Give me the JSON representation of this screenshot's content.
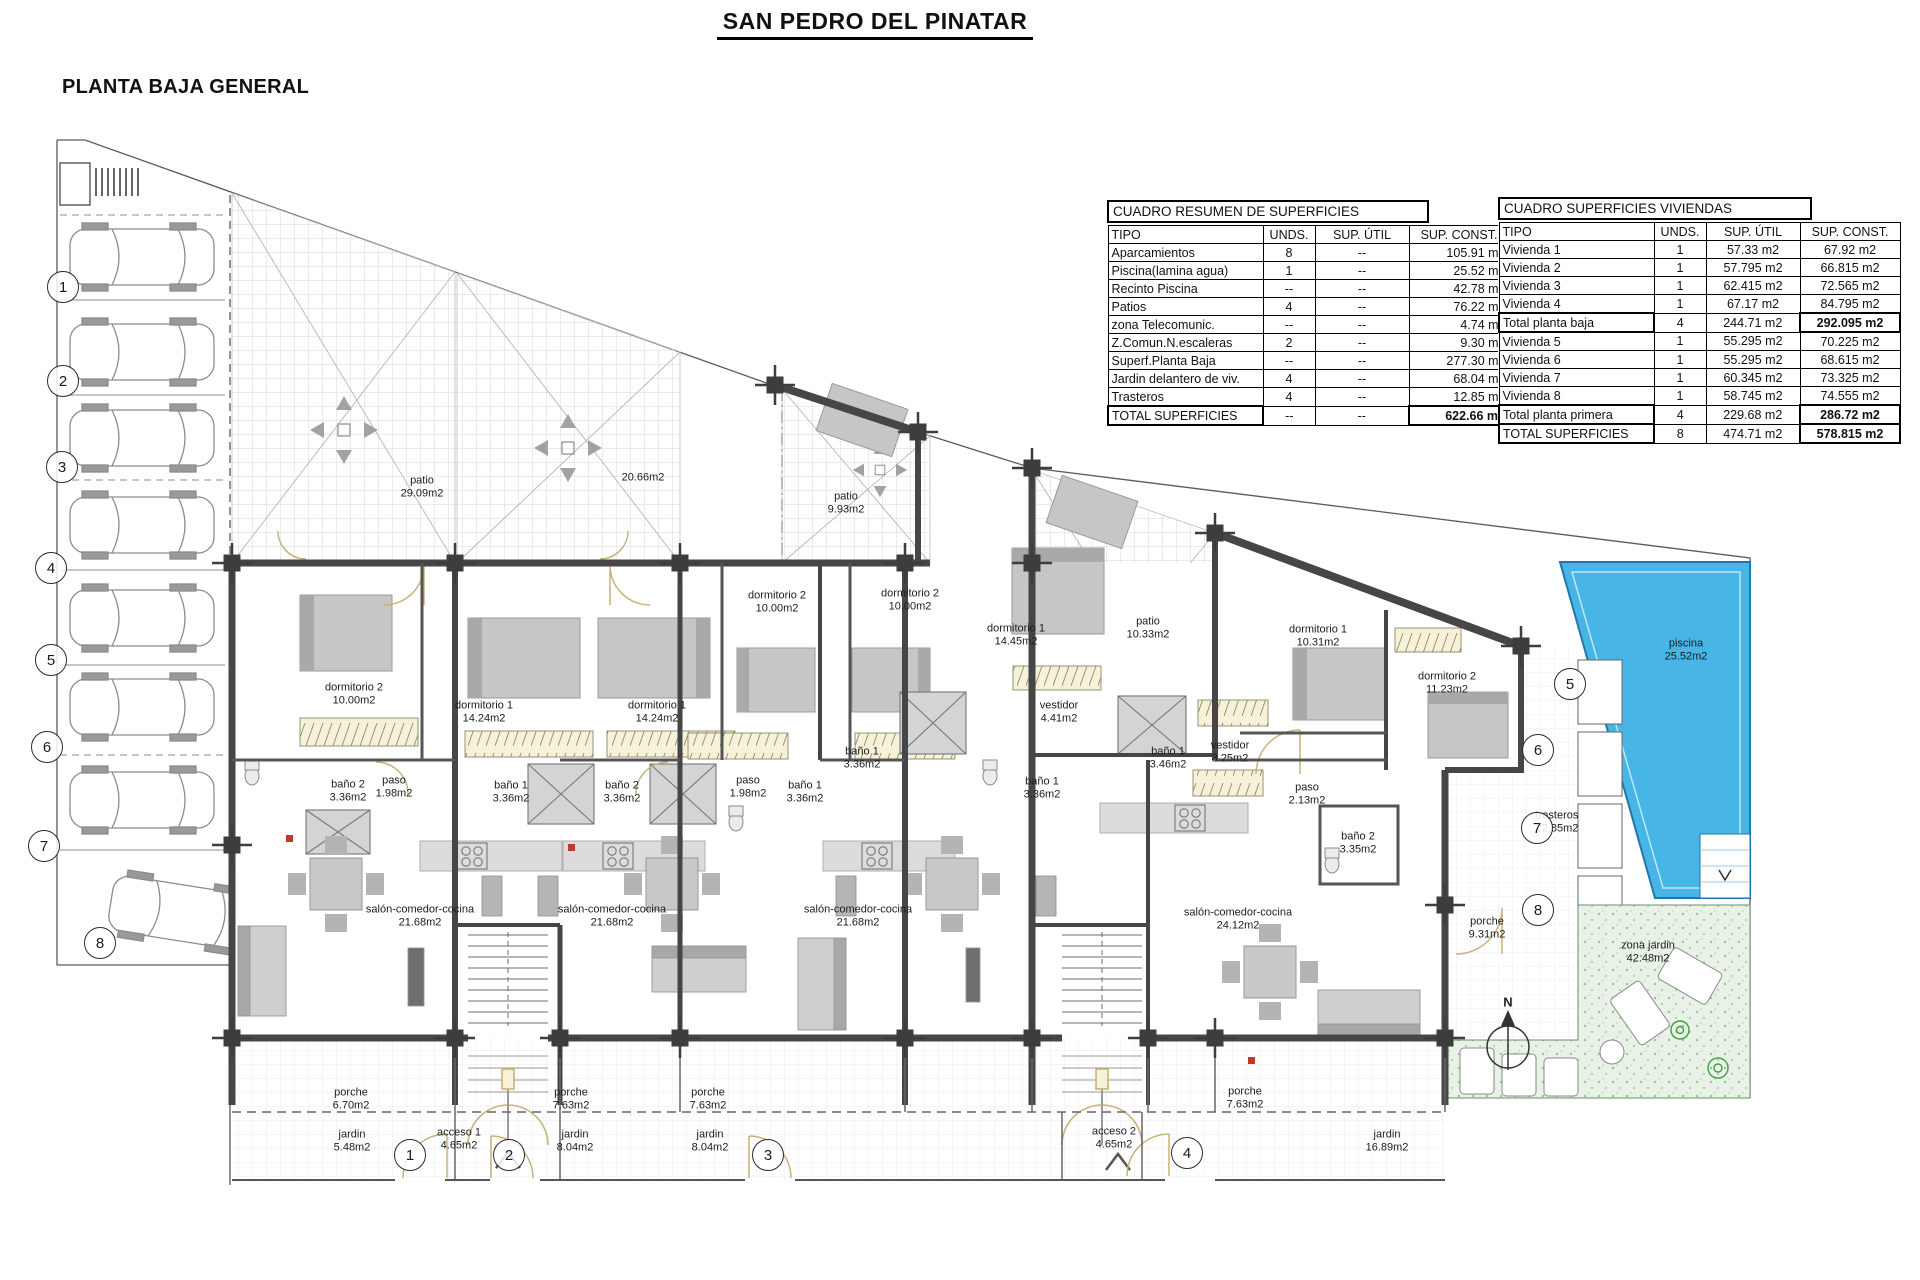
{
  "page": {
    "title": "SAN PEDRO DEL PINATAR",
    "subtitle": "PLANTA BAJA GENERAL"
  },
  "summary_table": {
    "title": "CUADRO RESUMEN DE SUPERFICIES",
    "columns": [
      "TIPO",
      "UNDS.",
      "SUP. ÚTIL",
      "SUP. CONST."
    ],
    "rows": [
      {
        "tipo": "Aparcamientos",
        "unds": "8",
        "util": "--",
        "const": "105.91 m2",
        "total": false
      },
      {
        "tipo": "Piscina(lamina agua)",
        "unds": "1",
        "util": "--",
        "const": "25.52 m2",
        "total": false
      },
      {
        "tipo": "Recinto Piscina",
        "unds": "--",
        "util": "--",
        "const": "42.78 m2",
        "total": false
      },
      {
        "tipo": "Patios",
        "unds": "4",
        "util": "--",
        "const": "76.22 m2",
        "total": false
      },
      {
        "tipo": "zona Telecomunic.",
        "unds": "--",
        "util": "--",
        "const": "4.74 m2",
        "total": false
      },
      {
        "tipo": "Z.Comun.N.escaleras",
        "unds": "2",
        "util": "--",
        "const": "9.30 m2",
        "total": false
      },
      {
        "tipo": "Superf.Planta Baja",
        "unds": "--",
        "util": "--",
        "const": "277.30 m2",
        "total": false
      },
      {
        "tipo": "Jardin delantero de viv.",
        "unds": "4",
        "util": "--",
        "const": "68.04 m2",
        "total": false
      },
      {
        "tipo": "Trasteros",
        "unds": "4",
        "util": "--",
        "const": "12.85 m2",
        "total": false
      },
      {
        "tipo": "TOTAL SUPERFICIES",
        "unds": "--",
        "util": "--",
        "const": "622.66 m2",
        "total": true
      }
    ]
  },
  "dwellings_table": {
    "title": "CUADRO SUPERFICIES VIVIENDAS",
    "columns": [
      "TIPO",
      "UNDS.",
      "SUP. ÚTIL",
      "SUP. CONST."
    ],
    "rows": [
      {
        "tipo": "Vivienda 1",
        "unds": "1",
        "util": "57.33 m2",
        "const": "67.92 m2",
        "total": false
      },
      {
        "tipo": "Vivienda 2",
        "unds": "1",
        "util": "57.795 m2",
        "const": "66.815 m2",
        "total": false
      },
      {
        "tipo": "Vivienda 3",
        "unds": "1",
        "util": "62.415 m2",
        "const": "72.565 m2",
        "total": false
      },
      {
        "tipo": "Vivienda 4",
        "unds": "1",
        "util": "67.17 m2",
        "const": "84.795 m2",
        "total": false
      },
      {
        "tipo": "Total planta baja",
        "unds": "4",
        "util": "244.71 m2",
        "const": "292.095 m2",
        "total": true
      },
      {
        "tipo": "Vivienda 5",
        "unds": "1",
        "util": "55.295 m2",
        "const": "70.225 m2",
        "total": false
      },
      {
        "tipo": "Vivienda 6",
        "unds": "1",
        "util": "55.295 m2",
        "const": "68.615 m2",
        "total": false
      },
      {
        "tipo": "Vivienda 7",
        "unds": "1",
        "util": "60.345 m2",
        "const": "73.325 m2",
        "total": false
      },
      {
        "tipo": "Vivienda 8",
        "unds": "1",
        "util": "58.745 m2",
        "const": "74.555 m2",
        "total": false
      },
      {
        "tipo": "Total planta primera",
        "unds": "4",
        "util": "229.68 m2",
        "const": "286.72 m2",
        "total": true
      },
      {
        "tipo": "TOTAL SUPERFICIES",
        "unds": "8",
        "util": "474.71 m2",
        "const": "578.815 m2",
        "total": true
      }
    ]
  },
  "plan_labels": [
    {
      "name": "patio",
      "area": "29.09m2",
      "x": 422,
      "y": 487
    },
    {
      "name": "",
      "area": "20.66m2",
      "x": 643,
      "y": 478
    },
    {
      "name": "patio",
      "area": "9.93m2",
      "x": 846,
      "y": 503
    },
    {
      "name": "patio",
      "area": "10.33m2",
      "x": 1148,
      "y": 628
    },
    {
      "name": "dormitorio 2",
      "area": "10.00m2",
      "x": 354,
      "y": 694
    },
    {
      "name": "dormitorio 1",
      "area": "14.24m2",
      "x": 484,
      "y": 712
    },
    {
      "name": "dormitorio 1",
      "area": "14.24m2",
      "x": 657,
      "y": 712
    },
    {
      "name": "dormitorio 2",
      "area": "10.00m2",
      "x": 777,
      "y": 602
    },
    {
      "name": "dormitorio 2",
      "area": "10.00m2",
      "x": 910,
      "y": 600
    },
    {
      "name": "dormitorio 1",
      "area": "14.45m2",
      "x": 1016,
      "y": 635
    },
    {
      "name": "dormitorio 1",
      "area": "10.31m2",
      "x": 1318,
      "y": 636
    },
    {
      "name": "dormitorio 2",
      "area": "11.23m2",
      "x": 1447,
      "y": 683
    },
    {
      "name": "vestidor",
      "area": "4.41m2",
      "x": 1059,
      "y": 712
    },
    {
      "name": "vestidor",
      "area": "3.25m2",
      "x": 1230,
      "y": 752
    },
    {
      "name": "baño 1",
      "area": "3.46m2",
      "x": 1168,
      "y": 758
    },
    {
      "name": "paso",
      "area": "2.13m2",
      "x": 1307,
      "y": 794
    },
    {
      "name": "baño 2",
      "area": "3.35m2",
      "x": 1358,
      "y": 843
    },
    {
      "name": "baño 2",
      "area": "3.36m2",
      "x": 348,
      "y": 791
    },
    {
      "name": "paso",
      "area": "1.98m2",
      "x": 394,
      "y": 787
    },
    {
      "name": "baño 1",
      "area": "3.36m2",
      "x": 511,
      "y": 792
    },
    {
      "name": "baño 2",
      "area": "3.36m2",
      "x": 622,
      "y": 792
    },
    {
      "name": "paso",
      "area": "1.98m2",
      "x": 748,
      "y": 787
    },
    {
      "name": "baño 1",
      "area": "3.36m2",
      "x": 805,
      "y": 792
    },
    {
      "name": "baño 1",
      "area": "3.36m2",
      "x": 862,
      "y": 758
    },
    {
      "name": "baño 1",
      "area": "3.36m2",
      "x": 1042,
      "y": 788
    },
    {
      "name": "salón-comedor-cocina",
      "area": "21.68m2",
      "x": 420,
      "y": 916
    },
    {
      "name": "salón-comedor-cocina",
      "area": "21.68m2",
      "x": 612,
      "y": 916
    },
    {
      "name": "salón-comedor-cocina",
      "area": "21.68m2",
      "x": 858,
      "y": 916
    },
    {
      "name": "salón-comedor-cocina",
      "area": "24.12m2",
      "x": 1238,
      "y": 919
    },
    {
      "name": "porche",
      "area": "9.31m2",
      "x": 1487,
      "y": 928
    },
    {
      "name": "trasteros",
      "area": "12.85m2",
      "x": 1557,
      "y": 822
    },
    {
      "name": "piscina",
      "area": "25.52m2",
      "x": 1686,
      "y": 650
    },
    {
      "name": "zona jardin",
      "area": "42.48m2",
      "x": 1648,
      "y": 952
    },
    {
      "name": "porche",
      "area": "6.70m2",
      "x": 351,
      "y": 1099
    },
    {
      "name": "jardin",
      "area": "5.48m2",
      "x": 352,
      "y": 1141
    },
    {
      "name": "acceso 1",
      "area": "4.65m2",
      "x": 459,
      "y": 1139
    },
    {
      "name": "porche",
      "area": "7.63m2",
      "x": 571,
      "y": 1099
    },
    {
      "name": "jardin",
      "area": "8.04m2",
      "x": 575,
      "y": 1141
    },
    {
      "name": "porche",
      "area": "7.63m2",
      "x": 708,
      "y": 1099
    },
    {
      "name": "jardin",
      "area": "8.04m2",
      "x": 710,
      "y": 1141
    },
    {
      "name": "acceso 2",
      "area": "4.65m2",
      "x": 1114,
      "y": 1138
    },
    {
      "name": "porche",
      "area": "7.63m2",
      "x": 1245,
      "y": 1098
    },
    {
      "name": "jardin",
      "area": "16.89m2",
      "x": 1387,
      "y": 1141
    }
  ],
  "circle_markers": [
    {
      "n": "1",
      "x": 63,
      "y": 287
    },
    {
      "n": "2",
      "x": 63,
      "y": 381
    },
    {
      "n": "3",
      "x": 62,
      "y": 467
    },
    {
      "n": "4",
      "x": 51,
      "y": 568
    },
    {
      "n": "5",
      "x": 51,
      "y": 660
    },
    {
      "n": "6",
      "x": 47,
      "y": 747
    },
    {
      "n": "7",
      "x": 44,
      "y": 846
    },
    {
      "n": "8",
      "x": 100,
      "y": 943
    },
    {
      "n": "1",
      "x": 410,
      "y": 1155
    },
    {
      "n": "2",
      "x": 509,
      "y": 1155
    },
    {
      "n": "3",
      "x": 768,
      "y": 1155
    },
    {
      "n": "4",
      "x": 1187,
      "y": 1153
    },
    {
      "n": "5",
      "x": 1570,
      "y": 684
    },
    {
      "n": "6",
      "x": 1538,
      "y": 750
    },
    {
      "n": "7",
      "x": 1537,
      "y": 828
    },
    {
      "n": "8",
      "x": 1538,
      "y": 910
    }
  ],
  "north": {
    "label": "N"
  },
  "colors": {
    "pool": "#47b5e6",
    "garden": "#e9f2e6",
    "wall": "#464646",
    "door": "#c8b27a"
  }
}
